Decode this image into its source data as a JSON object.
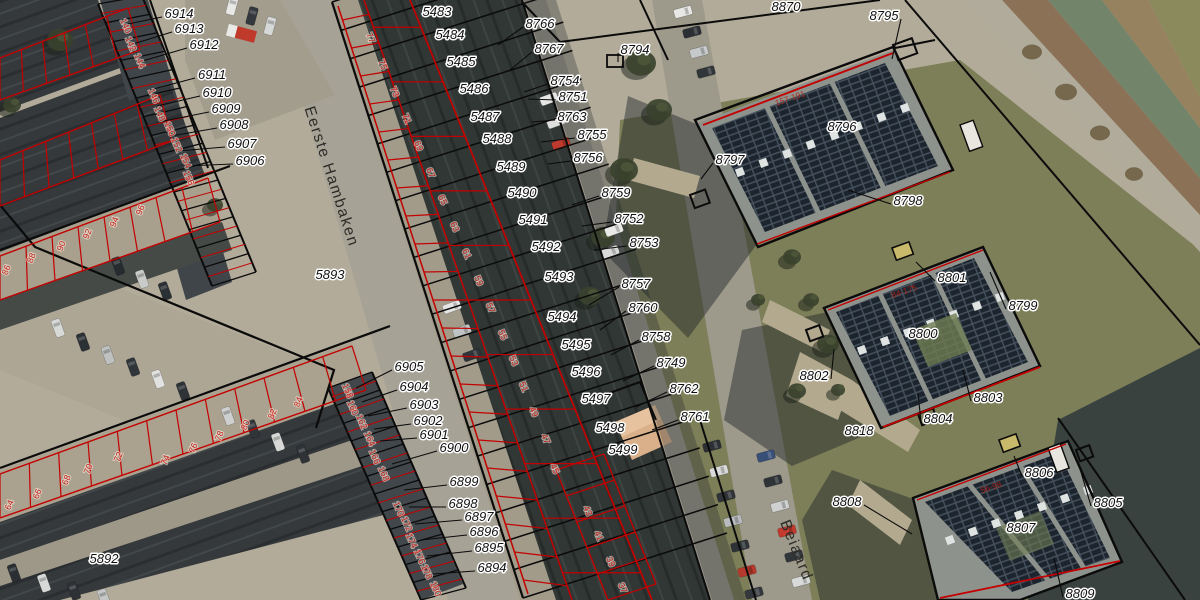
{
  "map": {
    "type": "aerial-cadastral-view",
    "street_labels": [
      {
        "text": "Eerste Hambaken",
        "x": 327,
        "y": 178,
        "rot": 72
      },
      {
        "text": "Beiaard",
        "x": 792,
        "y": 552,
        "rot": 68
      }
    ],
    "parcel_labels": [
      {
        "text": "6914",
        "x": 179,
        "y": 14,
        "lx": 128,
        "ly": 24
      },
      {
        "text": "6913",
        "x": 189,
        "y": 29,
        "lx": 133,
        "ly": 44
      },
      {
        "text": "6912",
        "x": 204,
        "y": 45,
        "lx": 139,
        "ly": 62
      },
      {
        "text": "6911",
        "x": 212,
        "y": 75,
        "lx": 150,
        "ly": 90
      },
      {
        "text": "6910",
        "x": 217,
        "y": 93,
        "lx": 157,
        "ly": 106
      },
      {
        "text": "6909",
        "x": 226,
        "y": 109,
        "lx": 164,
        "ly": 121
      },
      {
        "text": "6908",
        "x": 234,
        "y": 125,
        "lx": 171,
        "ly": 136
      },
      {
        "text": "6907",
        "x": 242,
        "y": 144,
        "lx": 178,
        "ly": 151
      },
      {
        "text": "6906",
        "x": 250,
        "y": 161,
        "lx": 185,
        "ly": 166
      },
      {
        "text": "5893",
        "x": 330,
        "y": 275
      },
      {
        "text": "5892",
        "x": 104,
        "y": 559
      },
      {
        "text": "6905",
        "x": 409,
        "y": 367,
        "lx": 356,
        "ly": 388
      },
      {
        "text": "6904",
        "x": 414,
        "y": 387,
        "lx": 362,
        "ly": 402
      },
      {
        "text": "6903",
        "x": 424,
        "y": 405,
        "lx": 368,
        "ly": 416
      },
      {
        "text": "6902",
        "x": 428,
        "y": 421,
        "lx": 374,
        "ly": 429
      },
      {
        "text": "6901",
        "x": 434,
        "y": 435,
        "lx": 380,
        "ly": 441
      },
      {
        "text": "6900",
        "x": 454,
        "y": 448,
        "lx": 392,
        "ly": 464
      },
      {
        "text": "6899",
        "x": 464,
        "y": 482,
        "lx": 404,
        "ly": 490
      },
      {
        "text": "6898",
        "x": 463,
        "y": 504,
        "lx": 409,
        "ly": 507
      },
      {
        "text": "6897",
        "x": 479,
        "y": 517,
        "lx": 415,
        "ly": 524
      },
      {
        "text": "6896",
        "x": 484,
        "y": 532,
        "lx": 421,
        "ly": 540
      },
      {
        "text": "6895",
        "x": 489,
        "y": 548,
        "lx": 427,
        "ly": 556
      },
      {
        "text": "6894",
        "x": 492,
        "y": 568,
        "lx": 433,
        "ly": 574
      },
      {
        "text": "5483",
        "x": 437,
        "y": 12
      },
      {
        "text": "5484",
        "x": 450,
        "y": 35
      },
      {
        "text": "5485",
        "x": 461,
        "y": 62
      },
      {
        "text": "5486",
        "x": 474,
        "y": 89
      },
      {
        "text": "5487",
        "x": 485,
        "y": 117
      },
      {
        "text": "5488",
        "x": 497,
        "y": 139
      },
      {
        "text": "5489",
        "x": 511,
        "y": 167
      },
      {
        "text": "5490",
        "x": 522,
        "y": 193
      },
      {
        "text": "5491",
        "x": 533,
        "y": 220
      },
      {
        "text": "5492",
        "x": 546,
        "y": 247
      },
      {
        "text": "5493",
        "x": 559,
        "y": 277
      },
      {
        "text": "5494",
        "x": 562,
        "y": 317
      },
      {
        "text": "5495",
        "x": 576,
        "y": 345
      },
      {
        "text": "5496",
        "x": 586,
        "y": 372
      },
      {
        "text": "5497",
        "x": 596,
        "y": 399
      },
      {
        "text": "5498",
        "x": 610,
        "y": 428
      },
      {
        "text": "5499",
        "x": 623,
        "y": 450
      },
      {
        "text": "8766",
        "x": 540,
        "y": 24,
        "lx": 498,
        "ly": 45
      },
      {
        "text": "8767",
        "x": 549,
        "y": 49,
        "lx": 510,
        "ly": 70
      },
      {
        "text": "8754",
        "x": 565,
        "y": 81,
        "lx": 524,
        "ly": 92
      },
      {
        "text": "8751",
        "x": 573,
        "y": 97,
        "lx": 528,
        "ly": 99
      },
      {
        "text": "8763",
        "x": 572,
        "y": 117,
        "lx": 532,
        "ly": 122
      },
      {
        "text": "8755",
        "x": 592,
        "y": 135,
        "lx": 541,
        "ly": 142
      },
      {
        "text": "8756",
        "x": 588,
        "y": 158,
        "lx": 548,
        "ly": 164
      },
      {
        "text": "8794",
        "x": 635,
        "y": 50,
        "lx": 618,
        "ly": 62
      },
      {
        "text": "8759",
        "x": 616,
        "y": 193,
        "lx": 572,
        "ly": 205
      },
      {
        "text": "8752",
        "x": 629,
        "y": 219,
        "lx": 582,
        "ly": 226
      },
      {
        "text": "8753",
        "x": 644,
        "y": 243,
        "lx": 594,
        "ly": 250
      },
      {
        "text": "8757",
        "x": 636,
        "y": 284,
        "lx": 589,
        "ly": 305
      },
      {
        "text": "8760",
        "x": 643,
        "y": 308,
        "lx": 600,
        "ly": 330
      },
      {
        "text": "8758",
        "x": 656,
        "y": 337,
        "lx": 611,
        "ly": 355
      },
      {
        "text": "8749",
        "x": 671,
        "y": 363,
        "lx": 623,
        "ly": 381
      },
      {
        "text": "8762",
        "x": 684,
        "y": 389,
        "lx": 636,
        "ly": 407
      },
      {
        "text": "8761",
        "x": 695,
        "y": 417,
        "lx": 652,
        "ly": 430
      },
      {
        "text": "8870",
        "x": 786,
        "y": 7
      },
      {
        "text": "8795",
        "x": 884,
        "y": 16,
        "lx": 892,
        "ly": 59
      },
      {
        "text": "8796",
        "x": 842,
        "y": 127
      },
      {
        "text": "8797",
        "x": 730,
        "y": 160,
        "lx": 701,
        "ly": 179
      },
      {
        "text": "8798",
        "x": 908,
        "y": 201,
        "lx": 848,
        "ly": 190
      },
      {
        "text": "8801",
        "x": 952,
        "y": 278,
        "lx": 916,
        "ly": 262
      },
      {
        "text": "8799",
        "x": 1023,
        "y": 306,
        "lx": 990,
        "ly": 272
      },
      {
        "text": "8800",
        "x": 923,
        "y": 334
      },
      {
        "text": "8802",
        "x": 814,
        "y": 376,
        "lx": 834,
        "ly": 349
      },
      {
        "text": "8803",
        "x": 988,
        "y": 398,
        "lx": 963,
        "ly": 370
      },
      {
        "text": "8804",
        "x": 938,
        "y": 419,
        "lx": 918,
        "ly": 393
      },
      {
        "text": "8818",
        "x": 859,
        "y": 431
      },
      {
        "text": "8806",
        "x": 1039,
        "y": 473,
        "lx": 1014,
        "ly": 456
      },
      {
        "text": "8805",
        "x": 1108,
        "y": 503,
        "lx": 1078,
        "ly": 462
      },
      {
        "text": "8807",
        "x": 1021,
        "y": 528
      },
      {
        "text": "8808",
        "x": 847,
        "y": 502,
        "lx": 912,
        "ly": 534
      },
      {
        "text": "8809",
        "x": 1080,
        "y": 594,
        "lx": 1054,
        "ly": 558
      }
    ],
    "house_numbers": [
      {
        "text": "140",
        "x": 123,
        "y": 27,
        "rot": 67
      },
      {
        "text": "142",
        "x": 128,
        "y": 45,
        "rot": 67
      },
      {
        "text": "144",
        "x": 137,
        "y": 62,
        "rot": 67
      },
      {
        "text": "146",
        "x": 151,
        "y": 97,
        "rot": 67
      },
      {
        "text": "148",
        "x": 157,
        "y": 115,
        "rot": 67
      },
      {
        "text": "150",
        "x": 167,
        "y": 130,
        "rot": 67
      },
      {
        "text": "152",
        "x": 174,
        "y": 146,
        "rot": 67
      },
      {
        "text": "154",
        "x": 183,
        "y": 162,
        "rot": 67
      },
      {
        "text": "156",
        "x": 186,
        "y": 179,
        "rot": 67
      },
      {
        "text": "158",
        "x": 345,
        "y": 392,
        "rot": 66
      },
      {
        "text": "160",
        "x": 350,
        "y": 409,
        "rot": 66
      },
      {
        "text": "162",
        "x": 359,
        "y": 423,
        "rot": 66
      },
      {
        "text": "164",
        "x": 367,
        "y": 440,
        "rot": 66
      },
      {
        "text": "166",
        "x": 372,
        "y": 458,
        "rot": 66
      },
      {
        "text": "168",
        "x": 381,
        "y": 475,
        "rot": 66
      },
      {
        "text": "170",
        "x": 396,
        "y": 510,
        "rot": 66
      },
      {
        "text": "172",
        "x": 404,
        "y": 525,
        "rot": 66
      },
      {
        "text": "174",
        "x": 409,
        "y": 542,
        "rot": 66
      },
      {
        "text": "176",
        "x": 417,
        "y": 558,
        "rot": 66
      },
      {
        "text": "178",
        "x": 424,
        "y": 573,
        "rot": 66
      },
      {
        "text": "180",
        "x": 433,
        "y": 590,
        "rot": 66
      },
      {
        "text": "77",
        "x": 368,
        "y": 39,
        "rot": 66
      },
      {
        "text": "75",
        "x": 380,
        "y": 66,
        "rot": 66
      },
      {
        "text": "73",
        "x": 392,
        "y": 93,
        "rot": 66
      },
      {
        "text": "71",
        "x": 404,
        "y": 120,
        "rot": 66
      },
      {
        "text": "69",
        "x": 416,
        "y": 147,
        "rot": 66
      },
      {
        "text": "67",
        "x": 428,
        "y": 174,
        "rot": 66
      },
      {
        "text": "65",
        "x": 440,
        "y": 201,
        "rot": 66
      },
      {
        "text": "63",
        "x": 452,
        "y": 228,
        "rot": 66
      },
      {
        "text": "61",
        "x": 464,
        "y": 255,
        "rot": 66
      },
      {
        "text": "59",
        "x": 476,
        "y": 282,
        "rot": 66
      },
      {
        "text": "57",
        "x": 488,
        "y": 309,
        "rot": 66
      },
      {
        "text": "55",
        "x": 500,
        "y": 336,
        "rot": 66
      },
      {
        "text": "53",
        "x": 511,
        "y": 362,
        "rot": 66
      },
      {
        "text": "51",
        "x": 521,
        "y": 388,
        "rot": 66
      },
      {
        "text": "49",
        "x": 531,
        "y": 413,
        "rot": 66
      },
      {
        "text": "47",
        "x": 543,
        "y": 440,
        "rot": 66
      },
      {
        "text": "45",
        "x": 552,
        "y": 470,
        "rot": 66
      },
      {
        "text": "43",
        "x": 585,
        "y": 512,
        "rot": 66
      },
      {
        "text": "41",
        "x": 596,
        "y": 537,
        "rot": 66
      },
      {
        "text": "39",
        "x": 608,
        "y": 563,
        "rot": 66
      },
      {
        "text": "37",
        "x": 620,
        "y": 589,
        "rot": 66
      },
      {
        "text": "64",
        "x": 12,
        "y": 506,
        "rot": -68
      },
      {
        "text": "66",
        "x": 40,
        "y": 495,
        "rot": -68
      },
      {
        "text": "68",
        "x": 69,
        "y": 481,
        "rot": -68
      },
      {
        "text": "70",
        "x": 91,
        "y": 470,
        "rot": -68
      },
      {
        "text": "72",
        "x": 121,
        "y": 458,
        "rot": -68
      },
      {
        "text": "74",
        "x": 168,
        "y": 461,
        "rot": -68
      },
      {
        "text": "76",
        "x": 196,
        "y": 449,
        "rot": -68
      },
      {
        "text": "78",
        "x": 222,
        "y": 437,
        "rot": -68
      },
      {
        "text": "80",
        "x": 248,
        "y": 426,
        "rot": -68
      },
      {
        "text": "82",
        "x": 275,
        "y": 415,
        "rot": -68
      },
      {
        "text": "84",
        "x": 301,
        "y": 403,
        "rot": -68
      },
      {
        "text": "86",
        "x": 9,
        "y": 271,
        "rot": -68
      },
      {
        "text": "88",
        "x": 34,
        "y": 259,
        "rot": -68
      },
      {
        "text": "90",
        "x": 64,
        "y": 247,
        "rot": -68
      },
      {
        "text": "92",
        "x": 90,
        "y": 235,
        "rot": -68
      },
      {
        "text": "94",
        "x": 117,
        "y": 223,
        "rot": -68
      },
      {
        "text": "96",
        "x": 143,
        "y": 211,
        "rot": -68
      }
    ],
    "roof_range_labels": [
      {
        "text": "157-191",
        "x": 791,
        "y": 101,
        "rot": -19
      },
      {
        "text": "84-175",
        "x": 905,
        "y": 294,
        "rot": -19
      },
      {
        "text": "56-98",
        "x": 992,
        "y": 490,
        "rot": -19
      }
    ],
    "colors": {
      "boundary_black": "#0b0b0b",
      "parcel_red": "#c40000",
      "label_text": "#101010",
      "label_halo": "#ffffff",
      "house_number_red": "#c2221a",
      "street_text": "#2d2c27",
      "ground": "#b2ab9a",
      "road": "#a6a296",
      "roof_dark": "#343a38",
      "grass": "#7d7f58",
      "water": "#72856a",
      "solar_panel": "#1c242e"
    }
  }
}
